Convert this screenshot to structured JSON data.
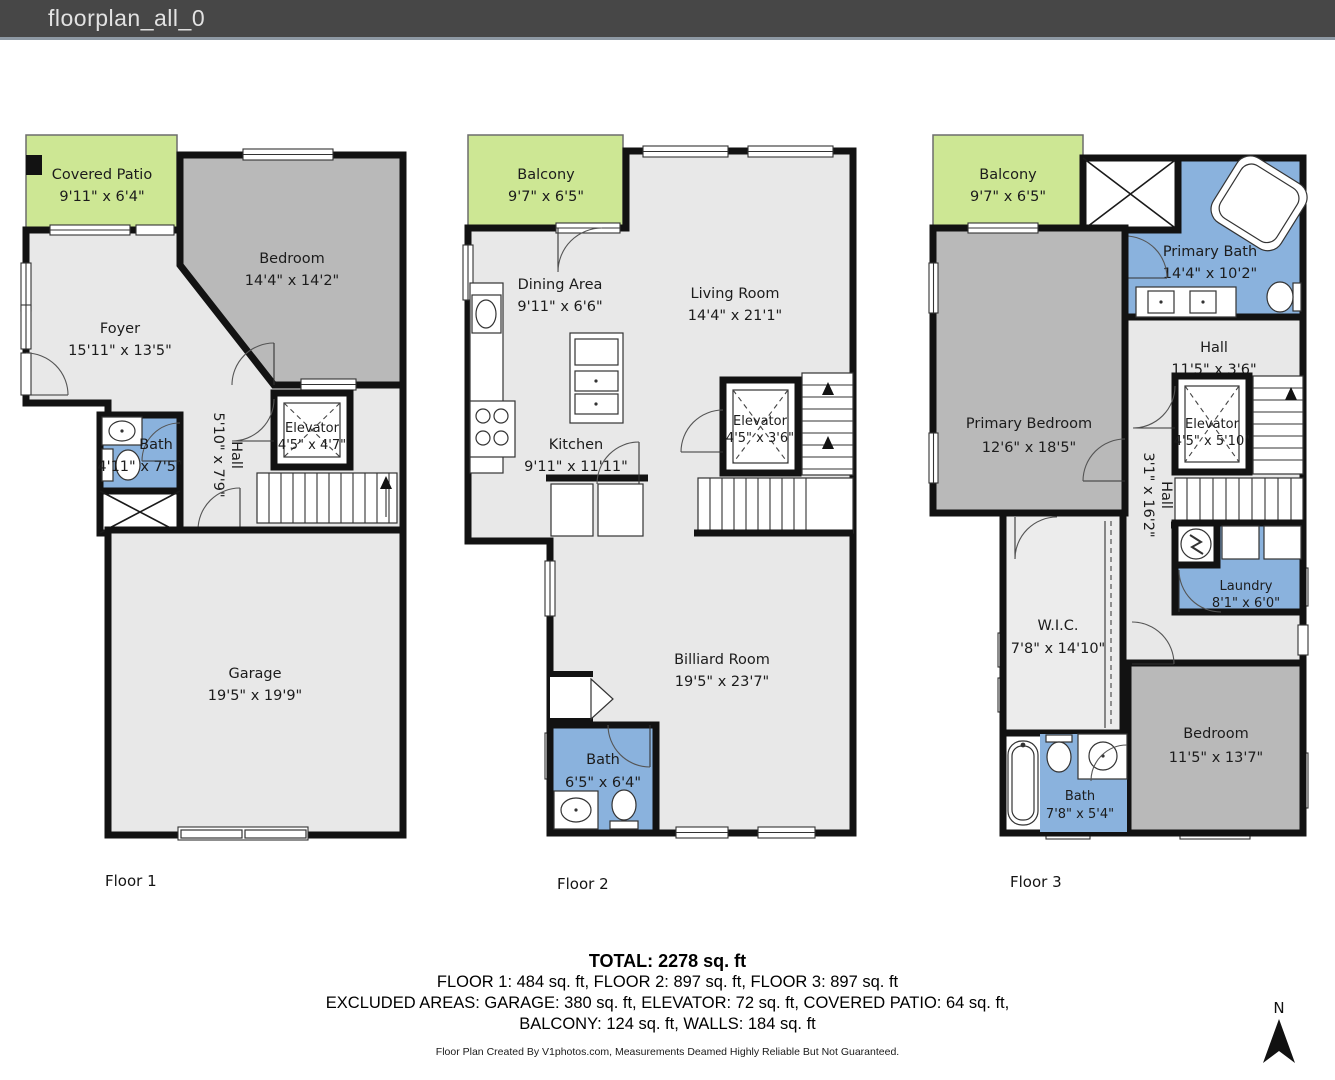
{
  "header": {
    "title": "floorplan_all_0"
  },
  "floors": [
    {
      "id": "floor-1",
      "label": "Floor 1",
      "rooms": {
        "covered_patio": {
          "name": "Covered Patio",
          "dims": "9'11\" x 6'4\""
        },
        "bedroom": {
          "name": "Bedroom",
          "dims": "14'4\" x 14'2\""
        },
        "foyer": {
          "name": "Foyer",
          "dims": "15'11\" x 13'5\""
        },
        "bath": {
          "name": "Bath",
          "dims": "4'11\" x 7'5\""
        },
        "hall": {
          "name": "Hall",
          "dims": "5'10\" x 7'9\""
        },
        "elevator": {
          "name": "Elevator",
          "dims": "4'5\" x 4'7\""
        },
        "garage": {
          "name": "Garage",
          "dims": "19'5\" x 19'9\""
        }
      }
    },
    {
      "id": "floor-2",
      "label": "Floor 2",
      "rooms": {
        "balcony": {
          "name": "Balcony",
          "dims": "9'7\" x 6'5\""
        },
        "dining_area": {
          "name": "Dining Area",
          "dims": "9'11\" x 6'6\""
        },
        "living_room": {
          "name": "Living Room",
          "dims": "14'4\" x 21'1\""
        },
        "kitchen": {
          "name": "Kitchen",
          "dims": "9'11\" x 11'11\""
        },
        "elevator": {
          "name": "Elevator",
          "dims": "4'5\" x 3'6\""
        },
        "billiard_room": {
          "name": "Billiard Room",
          "dims": "19'5\" x 23'7\""
        },
        "bath": {
          "name": "Bath",
          "dims": "6'5\" x 6'4\""
        }
      }
    },
    {
      "id": "floor-3",
      "label": "Floor 3",
      "rooms": {
        "balcony": {
          "name": "Balcony",
          "dims": "9'7\" x 6'5\""
        },
        "primary_bath": {
          "name": "Primary Bath",
          "dims": "14'4\" x 10'2\""
        },
        "hall_upper": {
          "name": "Hall",
          "dims": "11'5\" x 3'6\""
        },
        "primary_bedroom": {
          "name": "Primary Bedroom",
          "dims": "12'6\" x 18'5\""
        },
        "elevator": {
          "name": "Elevator",
          "dims": "4'5\" x 5'10\""
        },
        "hall_vertical": {
          "name": "Hall",
          "dims": "3'1\" x 16'2\""
        },
        "laundry": {
          "name": "Laundry",
          "dims": "8'1\" x 6'0\""
        },
        "wic": {
          "name": "W.I.C.",
          "dims": "7'8\" x 14'10\""
        },
        "bedroom": {
          "name": "Bedroom",
          "dims": "11'5\" x 13'7\""
        },
        "bath": {
          "name": "Bath",
          "dims": "7'8\" x 5'4\""
        }
      }
    }
  ],
  "summary": {
    "total": "TOTAL: 2278 sq. ft",
    "floors_line": "FLOOR 1: 484 sq. ft, FLOOR 2: 897 sq. ft, FLOOR 3: 897 sq. ft",
    "excluded_line1": "EXCLUDED AREAS: GARAGE: 380 sq. ft, ELEVATOR: 72 sq. ft, COVERED PATIO: 64 sq. ft,",
    "excluded_line2": "BALCONY: 124 sq. ft, WALLS: 184 sq. ft",
    "credit": "Floor Plan Created By V1photos.com, Measurements Deamed Highly Reliable But Not Guaranteed."
  },
  "compass": {
    "label": "N"
  },
  "colors": {
    "header_bg": "#474747",
    "balcony_green": "#cde794",
    "bath_blue": "#8ab2dd",
    "bedroom_gray": "#b9b9b9",
    "floor_light": "#e8e8e8",
    "wall_black": "#121212"
  }
}
